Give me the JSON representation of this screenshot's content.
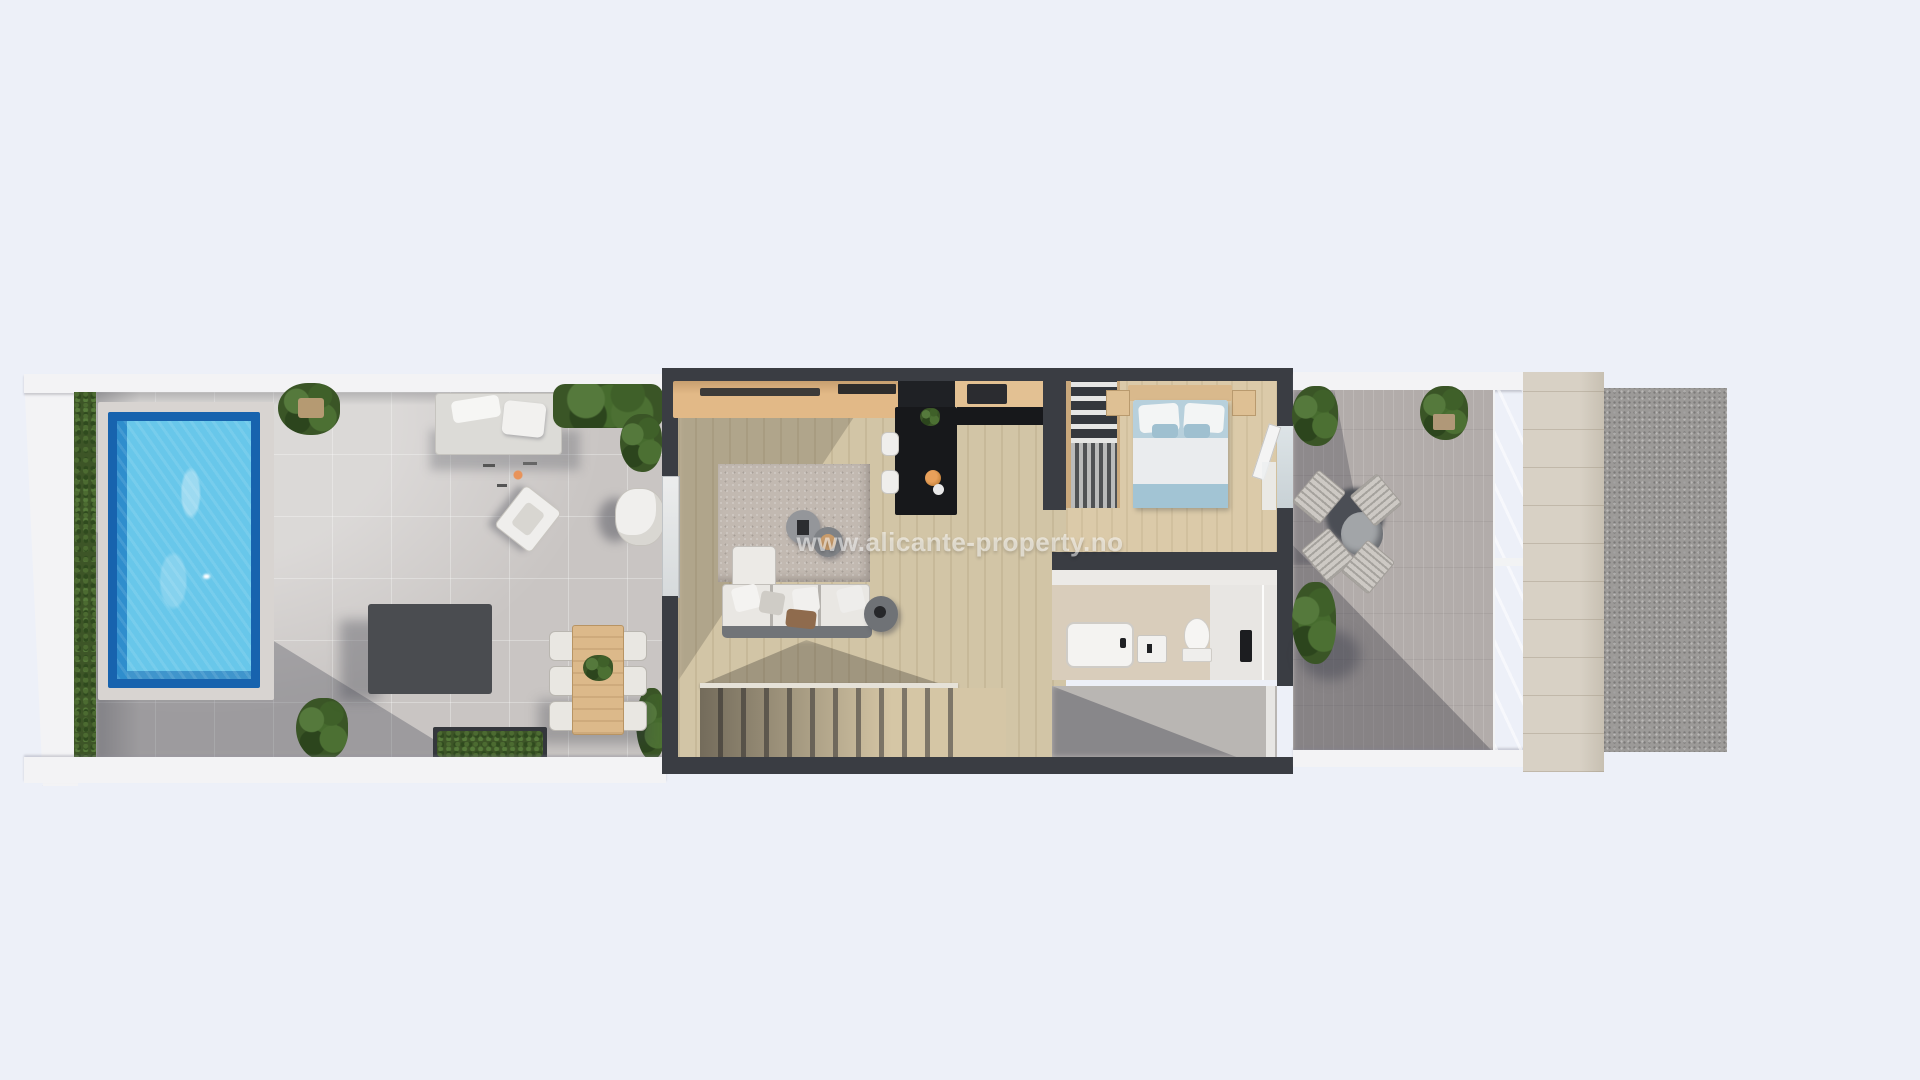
{
  "watermark": {
    "text": "www.alicante-property.no"
  },
  "scene": {
    "type": "3d-floorplan-top-down-render",
    "areas": [
      "pool-terrace",
      "swimming-pool",
      "privacy-hedge",
      "sun-lounger-area",
      "lounge-chair",
      "egg-chair",
      "modular-outdoor-sofa",
      "outdoor-dining-set",
      "planter-boxes",
      "living-room",
      "sofa",
      "area-rug",
      "coffee-tables",
      "tv-sideboard",
      "entry-hall",
      "kitchen-island",
      "kitchen-cabinets",
      "bar-stools",
      "wardrobe",
      "bedroom",
      "double-bed",
      "nightstands",
      "bathroom",
      "bathtub",
      "vanity-sink",
      "toilet",
      "shower",
      "staircase",
      "rear-patio",
      "right-terrace",
      "terrace-dining-table",
      "terrace-chairs",
      "glass-railing",
      "stone-side-wall",
      "gravel-pad"
    ]
  },
  "palette": {
    "bg": "#edf0f8",
    "wall-dark": "#3a3d43",
    "wall-white": "#f3f3f5",
    "hedge-green": "#3d5527",
    "tile": "#c9c5c3",
    "pool-rim": "#1763ae",
    "pool-water": "#68c7ea",
    "pool-deep": "#2f8ecd",
    "wood": "#d2c5a6",
    "bedroom-wood": "#dbcaa9",
    "rug": "#c2b9b1",
    "sideboard": "#e2b987",
    "cabinet": "#e3c193",
    "counter-black": "#17181b",
    "duvet": "#eaecee",
    "bed-teal": "#a2c4d4",
    "bath-beige": "#d9cdbb",
    "shower-white": "#e8e6e3",
    "patio": "#b9b6b3",
    "terrace-right": "#b2acaa",
    "stone": "#d8d1c5",
    "gravel": "#9c9a98",
    "furniture-white": "#efeeec",
    "table-wood": "#dcb98a",
    "chair-gray": "#e9e7e2",
    "table-dark": "#53565c",
    "watermark": "rgba(255,255,255,0.55)"
  }
}
